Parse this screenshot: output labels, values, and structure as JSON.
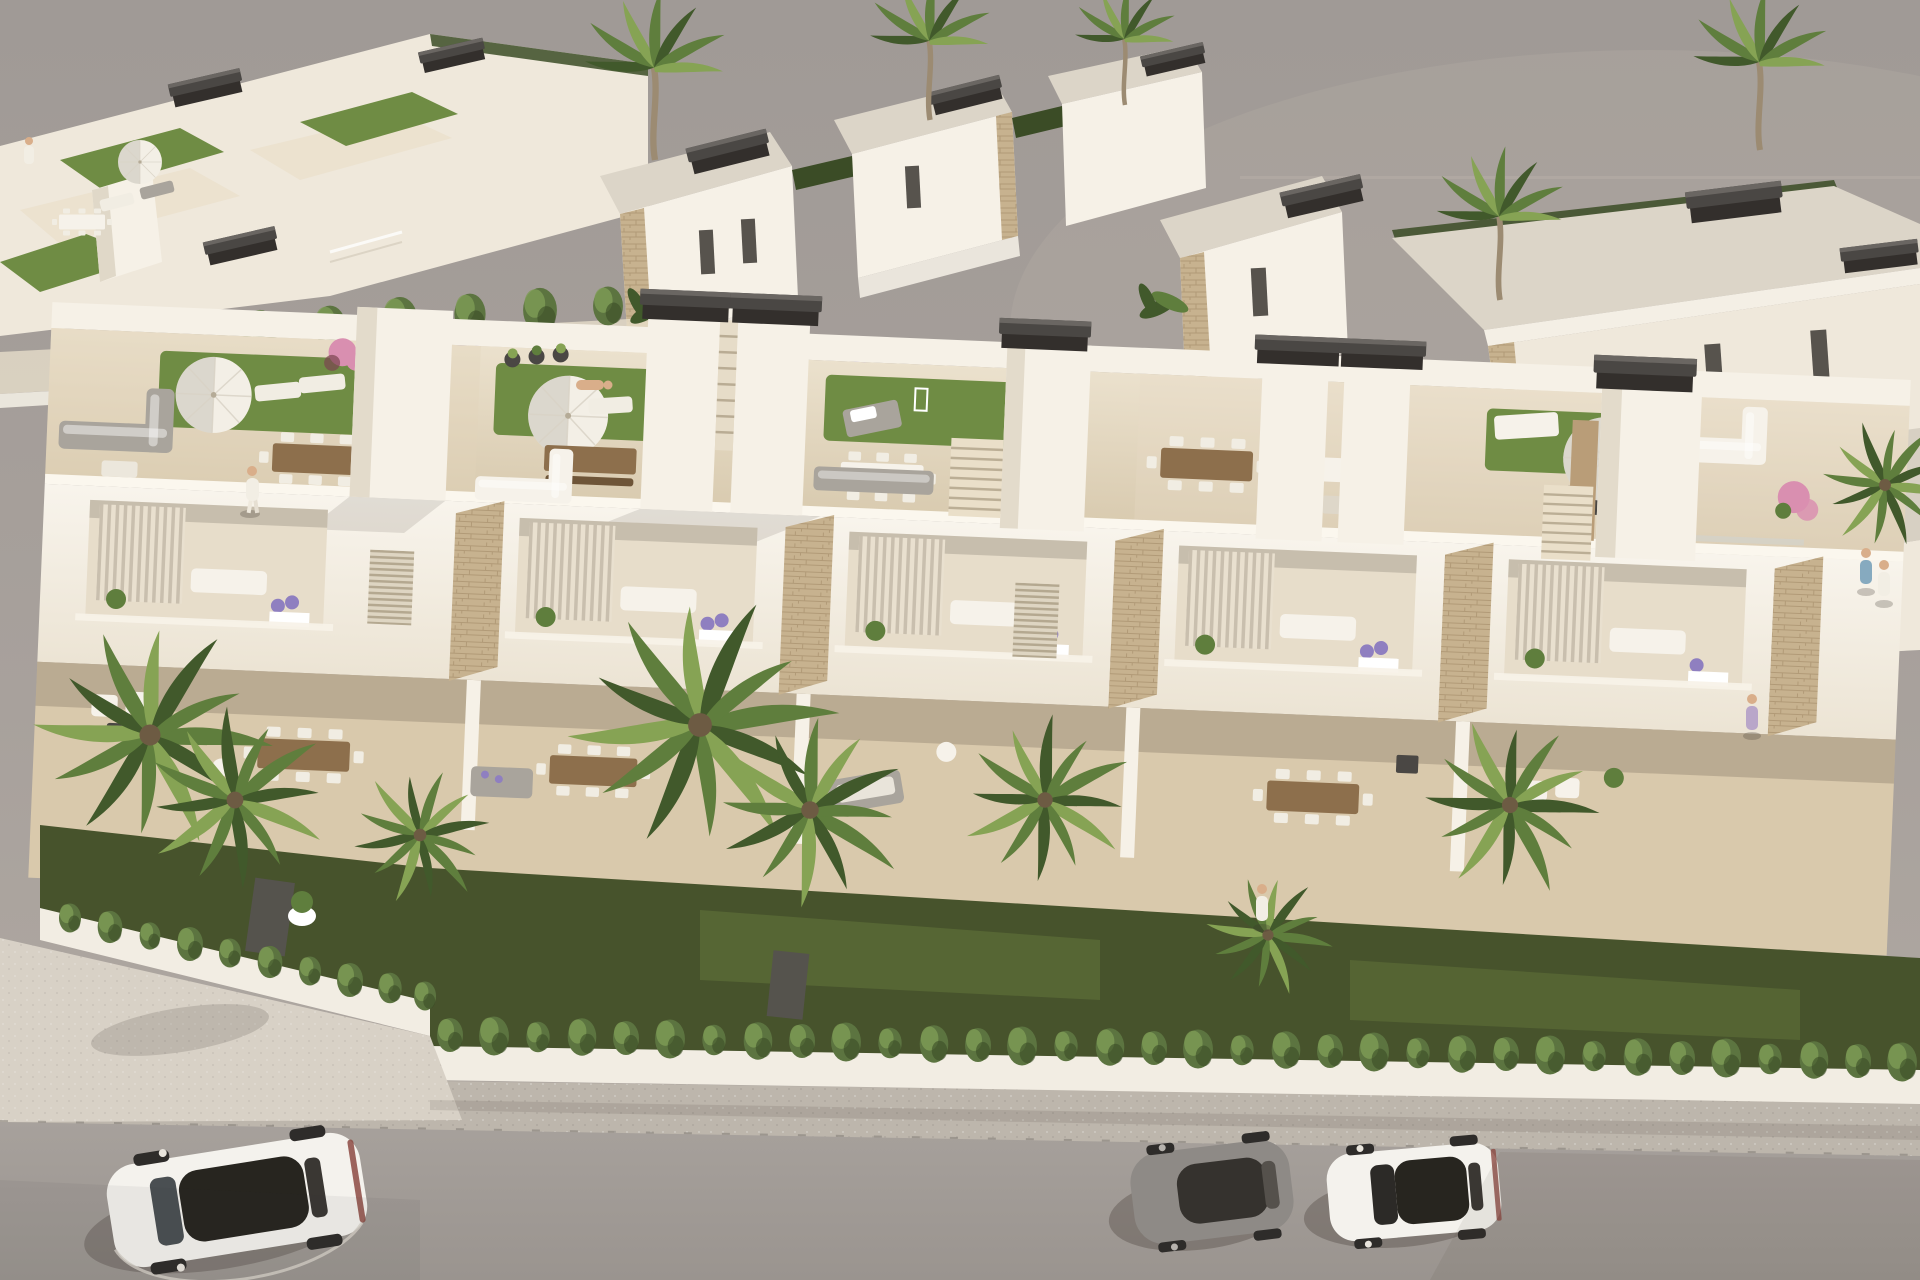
{
  "scene": {
    "type": "aerial-architectural-render",
    "setting": "Aerial 3D render of a modern white Mediterranean townhouse development with roof terraces, gardens, palm trees and a street with parked cars",
    "lighting": "warm afternoon sunlight from the upper right, plain grey studio backdrop",
    "architecture": {
      "main_row_units": 5,
      "stair_towers": 7,
      "roof_terraces_with_turf": 4,
      "pergola_caps": 8,
      "stone_clad_panels": 5,
      "balconies_with_louvered_shutters": 5,
      "back_villas": 7
    },
    "street": {
      "parked_cars": 3,
      "hedge_tufts": 44,
      "sidewalk": true,
      "road": true
    },
    "vehicles": [
      {
        "name": "white-suv",
        "body": "white",
        "roof": "dark glass"
      },
      {
        "name": "gray-sports-coupe",
        "body": "gray",
        "roof": "dark glass"
      },
      {
        "name": "white-sedan",
        "body": "white",
        "roof": "dark glass"
      }
    ],
    "vegetation": [
      "fan-palm-trees",
      "cypress-hedge-row",
      "front-lawn-strip",
      "roof-turf-patches",
      "bougainvillea",
      "potted-plants",
      "flower-beds"
    ],
    "people_visible": 7,
    "furniture": [
      "outdoor-dining-sets",
      "corner-sofas",
      "sun-loungers",
      "daybeds",
      "parasols",
      "coffee-tables"
    ]
  },
  "palette": {
    "bg-top": "#a09a96",
    "bg-mid": "#a8a19c",
    "bg-low": "#b1aaa3",
    "cream": "#efe8db",
    "white-wall": "#f6f1e7",
    "facade-hi": "#f8f4ec",
    "facade-lo": "#ece4d4",
    "tile-hi": "#ebe1cd",
    "tile-lo": "#d9cbb0",
    "tile-warm": "#d9c9ac",
    "roof-gray": "#dcd5c8",
    "turf": "#6f8c44",
    "grass-dark": "#47532c",
    "grass-lit": "#667a3c",
    "hedge": "#5c7440",
    "hedge-hi": "#7e9c55",
    "hedge-dark": "#3b4c26",
    "palm": "#5f7e3d",
    "palm-dark": "#41592b",
    "palm-lite": "#86a354",
    "trunk": "#9c8b72",
    "stone": "#c7b28f",
    "stone-line": "#a8906c",
    "charcoal": "#4a4744",
    "charcoal-dark": "#332f2c",
    "sofa-gray": "#a9a49c",
    "cushion": "#f1ede3",
    "white-furn": "#f6f2ea",
    "wood": "#8d6f4c",
    "wood-dark": "#6e5538",
    "deck-wood": "#b99d78",
    "umbrella": "#f3efe6",
    "umbrella-shade": "#d8d2c5",
    "road": "#a7a19c",
    "road-dark": "#9a948f",
    "sidewalk": "#bdb6ac",
    "plaza": "#d8d1c6",
    "curb": "#ece7dd",
    "wall-white": "#f2ede3",
    "car-white": "#f4f2ed",
    "car-gray": "#8e8a86",
    "glass": "#27251f",
    "wheel": "#2e2c2a",
    "flower-purple": "#8f7fc0",
    "flower-pink": "#d98fb0",
    "flower-red": "#c05a4a",
    "maroon": "#7a4450",
    "skin": "#d9ae8a",
    "shirt-blue": "#86aabf",
    "shirt-white": "#f2eee4",
    "shirt-lav": "#b9a6c9",
    "shadow": "#3a332b"
  }
}
